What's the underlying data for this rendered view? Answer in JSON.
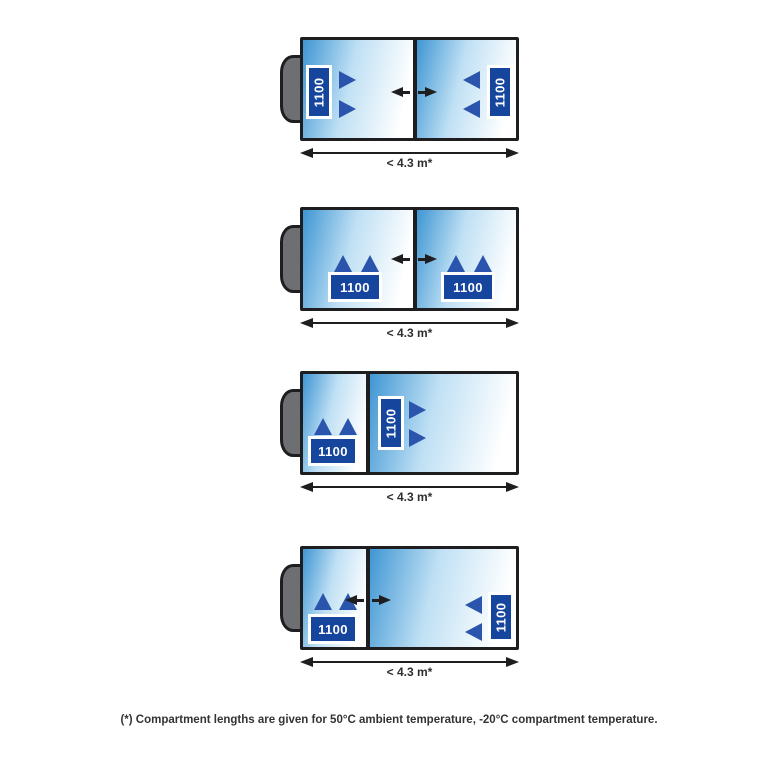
{
  "footnote": "(*) Compartment lengths are given for 50°C ambient temperature, -20°C compartment temperature.",
  "colors": {
    "compartment_blue": "#3F96D3",
    "compartment_fade": "#FFFFFF",
    "unit_box_navy": "#15459C",
    "airflow_blue": "#2B55AC",
    "outline_black": "#1E1E20",
    "cab_gray": "#6E6F72"
  },
  "diagrams": [
    {
      "dimension_label": "< 4.3 m*",
      "bulkhead": "movable",
      "units": [
        {
          "label": "1100"
        },
        {
          "label": "1100"
        }
      ]
    },
    {
      "dimension_label": "< 4.3 m*",
      "bulkhead": "movable",
      "units": [
        {
          "label": "1100"
        },
        {
          "label": "1100"
        }
      ]
    },
    {
      "dimension_label": "< 4.3 m*",
      "bulkhead": "fixed",
      "units": [
        {
          "label": "1100"
        },
        {
          "label": "1100"
        }
      ]
    },
    {
      "dimension_label": "< 4.3 m*",
      "bulkhead": "movable",
      "units": [
        {
          "label": "1100"
        },
        {
          "label": "1100"
        }
      ]
    }
  ]
}
